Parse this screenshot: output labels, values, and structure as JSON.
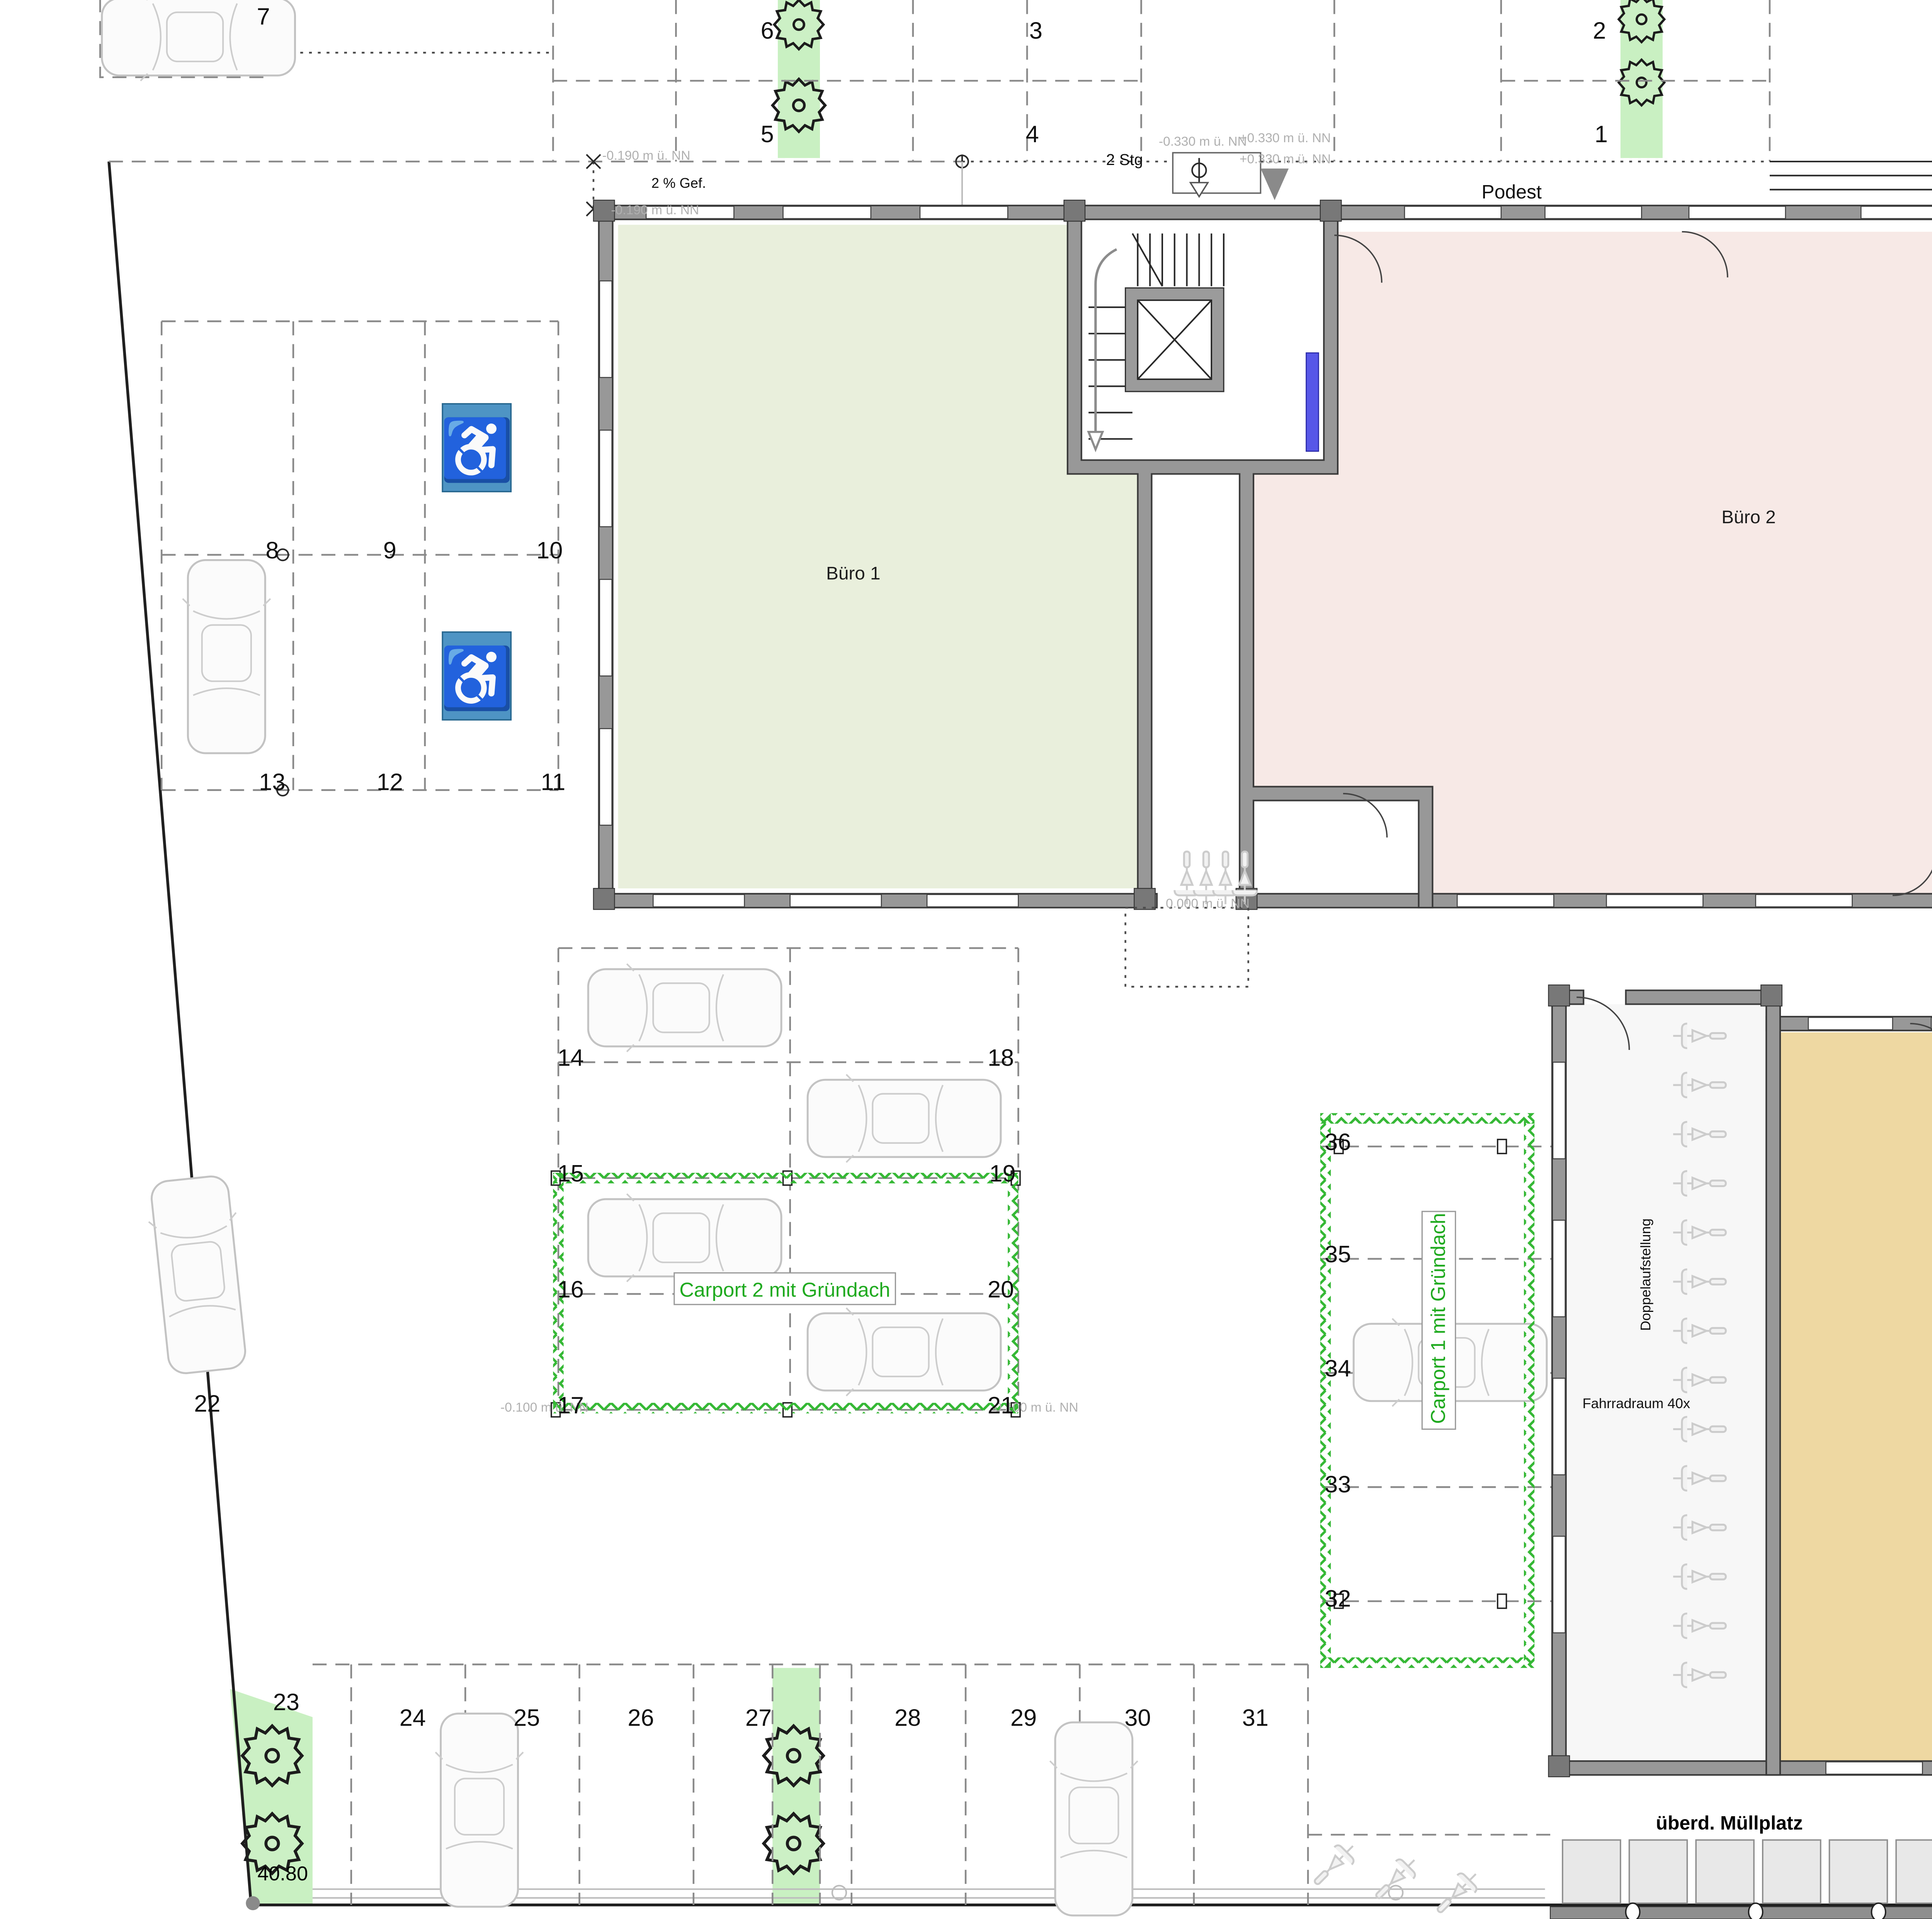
{
  "drawing": {
    "title": "Erdgeschoss",
    "site_dimension": "40.80"
  },
  "rooms": {
    "buero1": "Büro 1",
    "buero2": "Büro 2",
    "buero3": "Büro 3",
    "fahrradraum": "Fahrradraum 40x",
    "doppelaufstellung": "Doppelaufstellung"
  },
  "structures": {
    "carport1": "Carport 1 mit Gründach",
    "carport2": "Carport 2 mit Gründach",
    "muellplatz": "überd. Müllplatz"
  },
  "stairs": {
    "podest_top": "Podest",
    "podest_ne": "Podest",
    "podest_east": "Podest",
    "stg2_top": "2 Stg",
    "stg2_east": "2 Stg",
    "stg3_ne": "3 Stg",
    "gefaelle": "2 % Gef."
  },
  "elevations": {
    "nw_upper": "-0.190 m ü. NN",
    "nw_lower": "-0.190 m ü. NN",
    "n_minus330": "-0.330 m ü. NN",
    "n_plus330_a": "+0.330 m ü. NN",
    "n_plus330_b": "+0.330 m ü. NN",
    "ne_670": "-0.670 m ü. NN",
    "ne_550_a": "-0.550 m ü. NN",
    "ne_550_b": "-0.550 m ü. NN",
    "ne_550_c": "-0.550 m ü. NN",
    "ne_550_d": "-0.550 m ü. NN",
    "e_630_a": "-0.630 m ü. NN",
    "e_650": "-0.650 m ü. NN",
    "e_600_a": "-0.600 m ü. NN",
    "e_520": "-0.520 m ü. NN",
    "e_630_b": "-0.630 m ü. NN",
    "e_600_b": "-0.600 m ü. NN",
    "e_070": "-0.070 m ü. NN",
    "e_270": "-0.270 m ü. NN",
    "center_000": "0.000 m ü. NN",
    "carport2_w": "-0.100 m ü. NN",
    "carport2_e": "-0.100 m ü. NN",
    "se_100": "0.100 m ü. NN",
    "s_180": "-0.180 m ü. NN"
  },
  "parking": {
    "spot_numbers": [
      "1",
      "2",
      "3",
      "4",
      "5",
      "6",
      "7",
      "8",
      "9",
      "10",
      "11",
      "12",
      "13",
      "14",
      "15",
      "16",
      "17",
      "18",
      "19",
      "20",
      "21",
      "22",
      "23",
      "24",
      "25",
      "26",
      "27",
      "28",
      "29",
      "30",
      "31",
      "32",
      "33",
      "34",
      "35",
      "36"
    ]
  },
  "icons": {
    "wheelchair": "♿"
  },
  "colors": {
    "lawn": "#c9f0c2",
    "buero1_fill": "#e9efdc",
    "buero2_fill": "#f7e9e6",
    "buero3_fill": "#eed8a2",
    "wall": "#989898",
    "accessible_blue": "#4e94c4",
    "carport_green": "#1faa1f",
    "door_blue": "#5757e8",
    "elevation_text": "#b0b0b0"
  }
}
